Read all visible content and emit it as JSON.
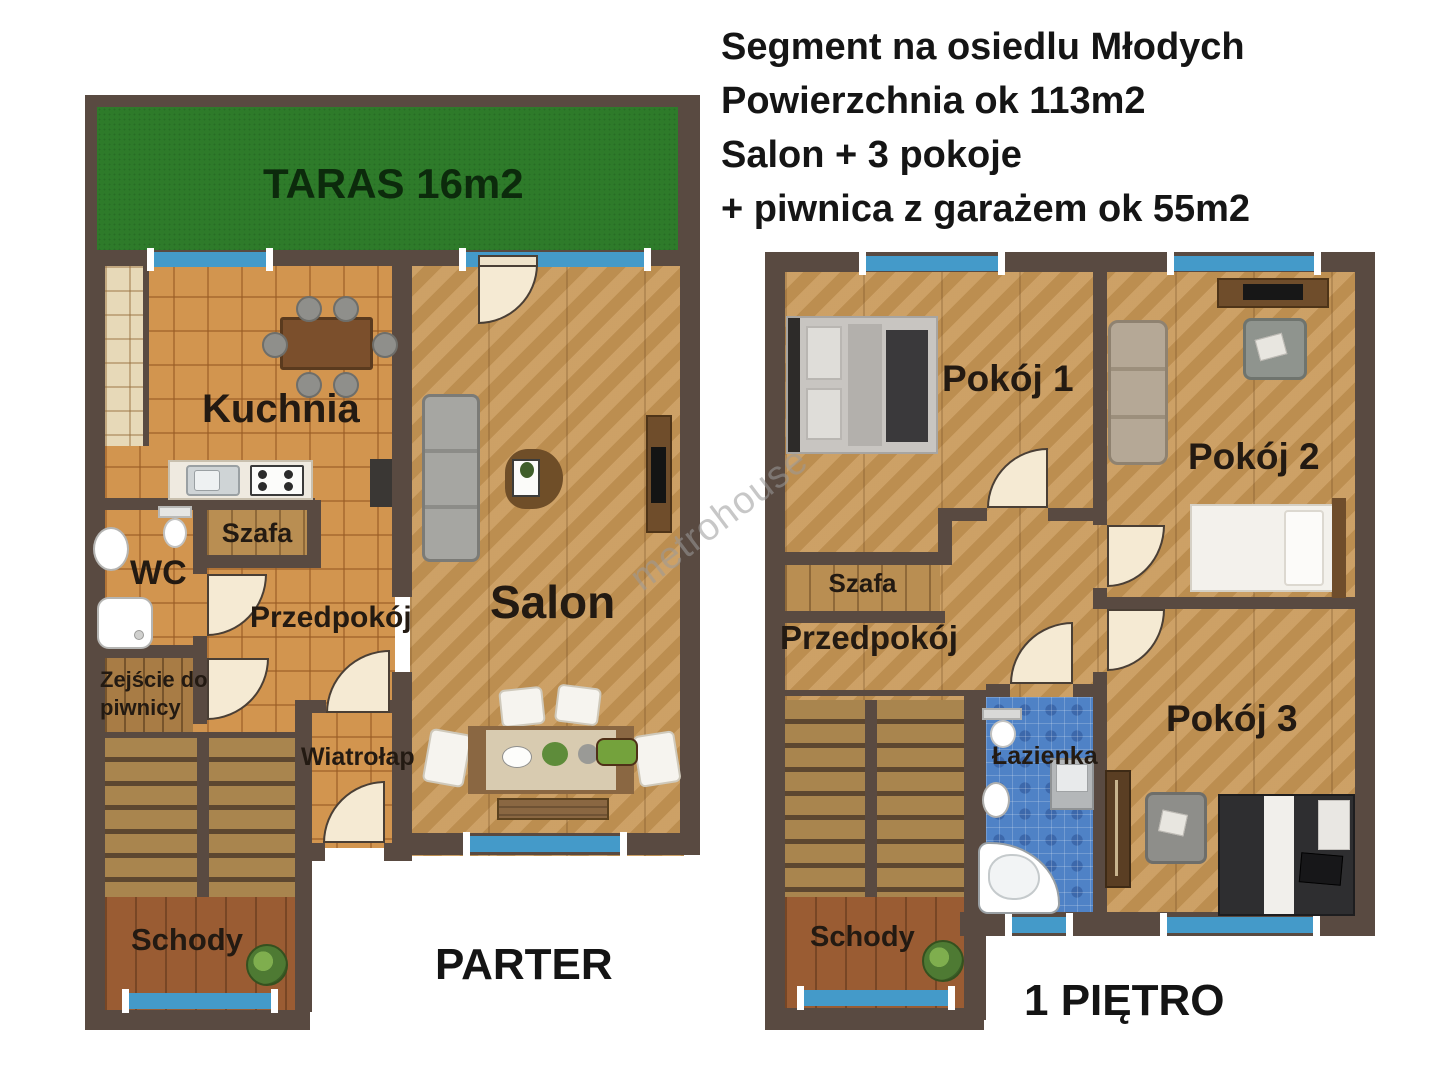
{
  "header": {
    "line1": "Segment na osiedlu Młodych",
    "line2": "Powierzchnia ok 113m2",
    "line3": "Salon + 3 pokoje",
    "line4": "+ piwnica z garażem ok 55m2"
  },
  "watermark": {
    "text": "metrohouse"
  },
  "parter": {
    "floor_title": "PARTER",
    "taras": "TARAS 16m2",
    "kuchnia": "Kuchnia",
    "wc": "WC",
    "szafa": "Szafa",
    "przedpokoj": "Przedpokój",
    "zejscie": "Zejście do piwnicy",
    "wiatrolap": "Wiatrołap",
    "salon": "Salon",
    "schody": "Schody"
  },
  "pietro": {
    "floor_title": "1 PIĘTRO",
    "pokoj1": "Pokój 1",
    "pokoj2": "Pokój 2",
    "pokoj3": "Pokój 3",
    "szafa": "Szafa",
    "przedpokoj": "Przedpokój",
    "lazienka": "Łazienka",
    "schody": "Schody"
  },
  "palette": {
    "wall_brown": "#594a41",
    "terrace_green": "#2e7b2a",
    "window_blue": "#449ac9",
    "tile_orange": "#d2954f",
    "wood_floor": "#c79757",
    "bathroom_blue": "#4f82c6",
    "door_cream": "#f5ead3"
  }
}
